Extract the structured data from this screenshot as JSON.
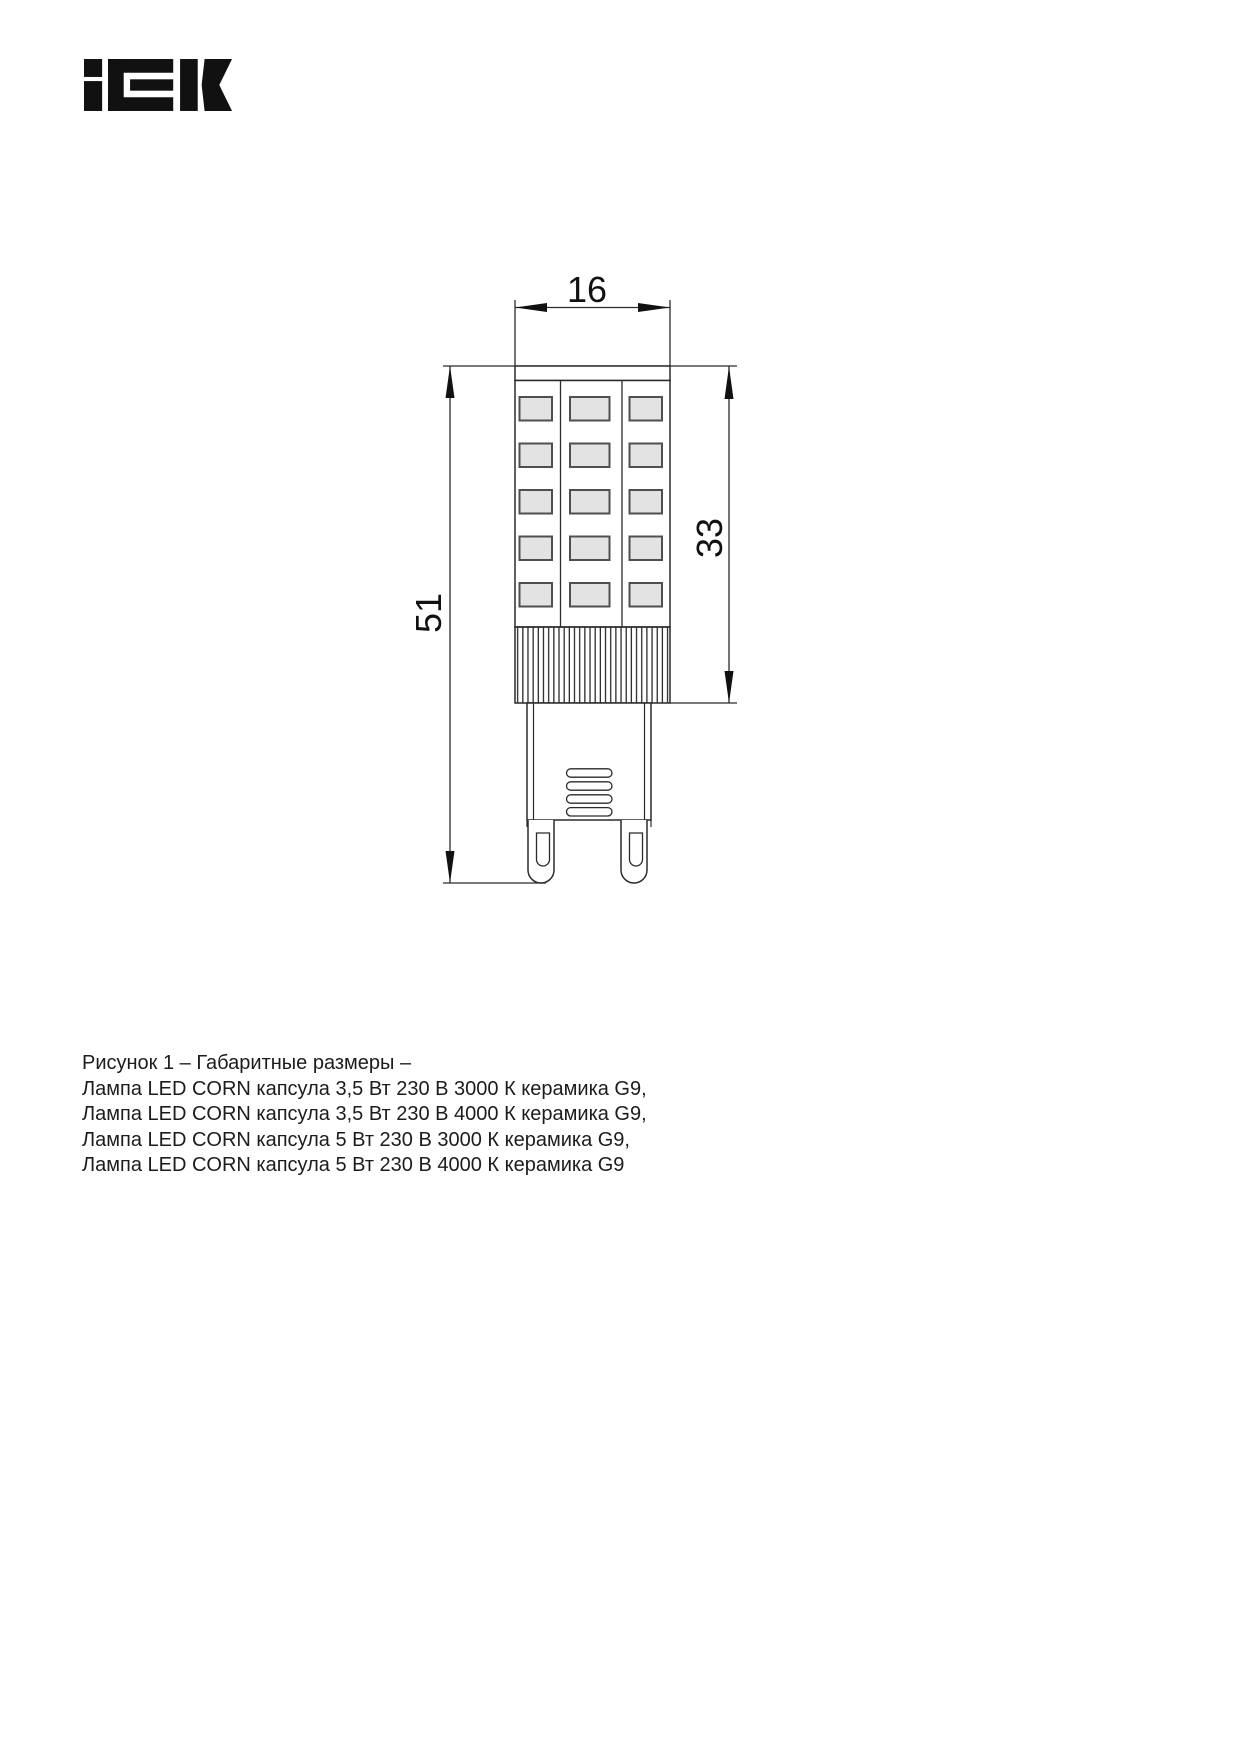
{
  "logo": {
    "text": "iEK"
  },
  "drawing": {
    "dim_width_mm": "16",
    "dim_total_height_mm": "51",
    "dim_led_section_mm": "33"
  },
  "caption": {
    "lines": [
      "Рисунок 1 – Габаритные размеры –",
      "Лампа LED CORN капсула 3,5 Вт 230 В 3000 К керамика G9,",
      "Лампа LED CORN капсула 3,5 Вт 230 В 4000 К керамика G9,",
      "Лампа LED CORN капсула 5 Вт 230 В 3000 К керамика G9,",
      "Лампа LED CORN капсула 5 Вт 230 В 4000 К керамика G9"
    ]
  },
  "colors": {
    "line": "#2b2b2b",
    "arrow": "#111111",
    "chip_fill": "#e3e3e3",
    "chip_border": "#4f4f4f",
    "logo": "#111111",
    "text": "#1c1c1c"
  }
}
